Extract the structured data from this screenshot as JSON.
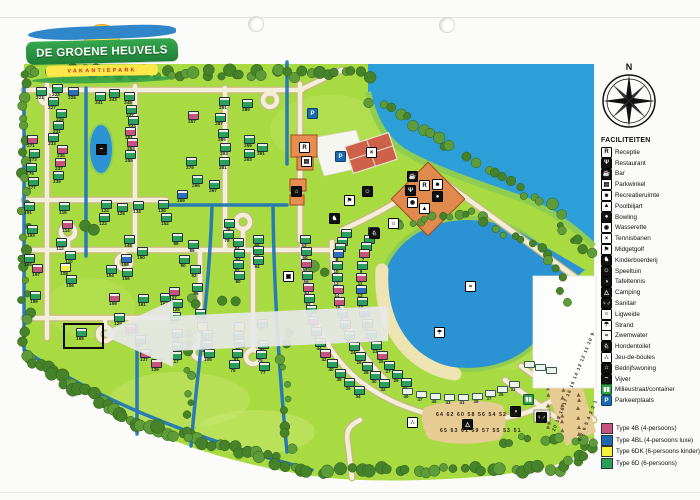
{
  "logo": {
    "line1": "DE GROENE HEUVELS",
    "line2": "VAKANTIEPARK"
  },
  "compass": {
    "north": "N"
  },
  "facilities_legend": {
    "title": "FACILITEITEN",
    "items": [
      {
        "label": "Receptie",
        "icon": "R",
        "variant": "light"
      },
      {
        "label": "Restaurant",
        "icon": "Ψ",
        "variant": "dark"
      },
      {
        "label": "Bar",
        "icon": "☕",
        "variant": "dark"
      },
      {
        "label": "Parkwinkel",
        "icon": "▤",
        "variant": "light"
      },
      {
        "label": "Recreatieruimte",
        "icon": "☻",
        "variant": "light"
      },
      {
        "label": "Poolbiljart",
        "icon": "▲",
        "variant": "light"
      },
      {
        "label": "Bowling",
        "icon": "●",
        "variant": "dark"
      },
      {
        "label": "Wasserette",
        "icon": "◉",
        "variant": "light"
      },
      {
        "label": "Tennisbanen",
        "icon": "×",
        "variant": "light"
      },
      {
        "label": "Midgetgolf",
        "icon": "⚑",
        "variant": "light"
      },
      {
        "label": "Kinderboerderij",
        "icon": "♞",
        "variant": "dark"
      },
      {
        "label": "Speeltuin",
        "icon": "☺",
        "variant": "dark"
      },
      {
        "label": "Tafeltennis",
        "icon": "◑",
        "variant": "dark"
      },
      {
        "label": "Camping",
        "icon": "△",
        "variant": "dark"
      },
      {
        "label": "Sanitair",
        "icon": "♀♂",
        "variant": "dark"
      },
      {
        "label": "Ligweide",
        "icon": "☼",
        "variant": "light"
      },
      {
        "label": "Strand",
        "icon": "☂",
        "variant": "light"
      },
      {
        "label": "Zwemwater",
        "icon": "≈",
        "variant": "light"
      },
      {
        "label": "Hondentoilet",
        "icon": "♘",
        "variant": "dark"
      },
      {
        "label": "Jeu-de-boules",
        "icon": "∴",
        "variant": "light"
      },
      {
        "label": "Bedrijfswoning",
        "icon": "⌂",
        "variant": "dark"
      },
      {
        "label": "Vijver",
        "icon": "~",
        "variant": "dark"
      },
      {
        "label": "Milieustraat/container",
        "icon": "▮▮",
        "variant": "green"
      },
      {
        "label": "Parkeerplaats",
        "icon": "P",
        "variant": "blue"
      }
    ]
  },
  "type_legend": {
    "items": [
      {
        "label": "Type 4B (4-persoons)",
        "color": "#c9537f"
      },
      {
        "label": "Type 4BL (4-persoons luxe)",
        "color": "#1d6ab0"
      },
      {
        "label": "Type 6DK (6-persoons kinder)",
        "color": "#f6f23c"
      },
      {
        "label": "Type 6D (6-persoons)",
        "color": "#2aa05c"
      }
    ]
  },
  "map": {
    "highlighted_plot": "165",
    "camping_field_rows": {
      "row1": "64 62 60 58 56 54 52 50",
      "row2": "65 63 61 59 57 55 53 51"
    },
    "pitch_rows": {
      "row1": "20 19 18 17 16 15 14 13 12 11 10 9",
      "row2": "8 7 6 5 4 3 2 1"
    },
    "type_colors": {
      "g": "#2aa05c",
      "p": "#c9537f",
      "b": "#2e6fbd",
      "y": "#f2ee4e"
    },
    "plots": [
      [
        "221",
        "g",
        40,
        90
      ],
      [
        "223",
        "g",
        56,
        87
      ],
      [
        "225",
        "b",
        72,
        90
      ],
      [
        "227",
        "g",
        52,
        100
      ],
      [
        "229",
        "g",
        60,
        112
      ],
      [
        "231",
        "g",
        57,
        124
      ],
      [
        "233",
        "g",
        52,
        136
      ],
      [
        "235",
        "p",
        61,
        148
      ],
      [
        "237",
        "p",
        59,
        161
      ],
      [
        "239",
        "g",
        57,
        174
      ],
      [
        "241",
        "g",
        99,
        95
      ],
      [
        "243",
        "g",
        113,
        92
      ],
      [
        "245",
        "g",
        128,
        95
      ],
      [
        "247",
        "g",
        130,
        108
      ],
      [
        "249",
        "g",
        132,
        119
      ],
      [
        "251",
        "p",
        129,
        130
      ],
      [
        "253",
        "p",
        131,
        141
      ],
      [
        "255",
        "g",
        129,
        153
      ],
      [
        "271",
        "p",
        31,
        138
      ],
      [
        "273",
        "g",
        33,
        152
      ],
      [
        "275",
        "g",
        30,
        166
      ],
      [
        "277",
        "g",
        32,
        180
      ],
      [
        "291",
        "g",
        223,
        100
      ],
      [
        "289",
        "g",
        246,
        102
      ],
      [
        "287",
        "g",
        219,
        116
      ],
      [
        "285",
        "g",
        222,
        132
      ],
      [
        "283",
        "g",
        224,
        146
      ],
      [
        "281",
        "g",
        223,
        160
      ],
      [
        "279",
        "g",
        190,
        160
      ],
      [
        "257",
        "p",
        192,
        114
      ],
      [
        "259",
        "g",
        248,
        138
      ],
      [
        "261",
        "g",
        261,
        146
      ],
      [
        "263",
        "g",
        248,
        152
      ],
      [
        "265",
        "g",
        196,
        178
      ],
      [
        "267",
        "g",
        213,
        183
      ],
      [
        "269",
        "b",
        181,
        193
      ],
      [
        "116",
        "g",
        63,
        205
      ],
      [
        "114",
        "p",
        66,
        223
      ],
      [
        "112",
        "g",
        60,
        241
      ],
      [
        "110",
        "g",
        69,
        254
      ],
      [
        "108",
        "y",
        64,
        266
      ],
      [
        "106",
        "g",
        70,
        278
      ],
      [
        "191",
        "g",
        28,
        205
      ],
      [
        "193",
        "g",
        31,
        228
      ],
      [
        "195",
        "g",
        28,
        257
      ],
      [
        "197",
        "p",
        36,
        267
      ],
      [
        "199",
        "g",
        34,
        294
      ],
      [
        "124",
        "g",
        105,
        203
      ],
      [
        "122",
        "g",
        103,
        216
      ],
      [
        "126",
        "g",
        121,
        206
      ],
      [
        "134",
        "g",
        137,
        204
      ],
      [
        "136",
        "g",
        162,
        203
      ],
      [
        "148",
        "g",
        128,
        238
      ],
      [
        "150",
        "g",
        141,
        250
      ],
      [
        "152",
        "g",
        165,
        216
      ],
      [
        "158",
        "b",
        125,
        257
      ],
      [
        "154",
        "g",
        110,
        268
      ],
      [
        "156",
        "g",
        126,
        271
      ],
      [
        "159",
        "p",
        113,
        296
      ],
      [
        "161",
        "g",
        142,
        297
      ],
      [
        "163",
        "g",
        164,
        296
      ],
      [
        "129",
        "g",
        118,
        316
      ],
      [
        "131",
        "p",
        129,
        327
      ],
      [
        "133",
        "g",
        139,
        338
      ],
      [
        "137",
        "p",
        144,
        352
      ],
      [
        "139",
        "p",
        155,
        362
      ],
      [
        "165",
        "g",
        80,
        331
      ],
      [
        "86",
        "g",
        192,
        243
      ],
      [
        "88",
        "g",
        176,
        236
      ],
      [
        "90",
        "g",
        183,
        258
      ],
      [
        "92",
        "g",
        194,
        268
      ],
      [
        "94",
        "g",
        238,
        252
      ],
      [
        "84",
        "g",
        237,
        241
      ],
      [
        "76",
        "g",
        228,
        222
      ],
      [
        "78",
        "g",
        227,
        233
      ],
      [
        "68",
        "g",
        257,
        238
      ],
      [
        "66",
        "g",
        257,
        249
      ],
      [
        "64",
        "g",
        257,
        259
      ],
      [
        "82",
        "g",
        237,
        263
      ],
      [
        "80",
        "g",
        238,
        274
      ],
      [
        "127",
        "p",
        173,
        290
      ],
      [
        "125",
        "g",
        176,
        302
      ],
      [
        "123",
        "g",
        174,
        315
      ],
      [
        "95",
        "g",
        196,
        286
      ],
      [
        "97",
        "g",
        199,
        312
      ],
      [
        "99",
        "y",
        201,
        325
      ],
      [
        "101",
        "g",
        206,
        333
      ],
      [
        "103",
        "g",
        206,
        343
      ],
      [
        "65",
        "y",
        238,
        325
      ],
      [
        "63",
        "g",
        237,
        334
      ],
      [
        "71",
        "g",
        261,
        322
      ],
      [
        "73",
        "g",
        262,
        343
      ],
      [
        "75",
        "g",
        260,
        353
      ],
      [
        "77",
        "g",
        263,
        365
      ],
      [
        "79",
        "g",
        233,
        363
      ],
      [
        "81",
        "g",
        238,
        342
      ],
      [
        "83",
        "g",
        236,
        352
      ],
      [
        "121",
        "g",
        176,
        332
      ],
      [
        "119",
        "g",
        176,
        345
      ],
      [
        "117",
        "g",
        175,
        354
      ],
      [
        "105",
        "g",
        208,
        352
      ],
      [
        "62",
        "g",
        304,
        238
      ],
      [
        "60",
        "g",
        305,
        250
      ],
      [
        "58",
        "p",
        305,
        262
      ],
      [
        "56",
        "g",
        306,
        274
      ],
      [
        "54",
        "p",
        307,
        286
      ],
      [
        "52",
        "g",
        308,
        297
      ],
      [
        "50",
        "g",
        310,
        308
      ],
      [
        "48",
        "p",
        312,
        319
      ],
      [
        "46",
        "g",
        315,
        330
      ],
      [
        "44",
        "g",
        319,
        341
      ],
      [
        "42",
        "p",
        324,
        352
      ],
      [
        "40",
        "g",
        331,
        362
      ],
      [
        "38",
        "g",
        339,
        372
      ],
      [
        "36",
        "g",
        348,
        381
      ],
      [
        "34",
        "g",
        358,
        389
      ],
      [
        "2",
        "g",
        345,
        232
      ],
      [
        "4",
        "g",
        341,
        240
      ],
      [
        "6",
        "g",
        339,
        246
      ],
      [
        "8",
        "b",
        337,
        252
      ],
      [
        "10",
        "g",
        336,
        264
      ],
      [
        "12",
        "g",
        336,
        276
      ],
      [
        "14",
        "p",
        337,
        288
      ],
      [
        "16",
        "p",
        338,
        300
      ],
      [
        "18",
        "g",
        341,
        312
      ],
      [
        "20",
        "g",
        344,
        323
      ],
      [
        "22",
        "g",
        348,
        334
      ],
      [
        "24",
        "g",
        353,
        345
      ],
      [
        "26",
        "g",
        359,
        355
      ],
      [
        "28",
        "g",
        366,
        365
      ],
      [
        "30",
        "g",
        374,
        374
      ],
      [
        "32",
        "g",
        383,
        382
      ],
      [
        "1",
        "g",
        372,
        230
      ],
      [
        "3",
        "g",
        368,
        238
      ],
      [
        "5",
        "g",
        365,
        245
      ],
      [
        "7",
        "p",
        363,
        252
      ],
      [
        "9",
        "g",
        361,
        264
      ],
      [
        "11",
        "p",
        360,
        276
      ],
      [
        "13",
        "b",
        360,
        288
      ],
      [
        "15",
        "g",
        361,
        300
      ],
      [
        "17",
        "b",
        363,
        311
      ],
      [
        "19",
        "g",
        366,
        322
      ],
      [
        "21",
        "g",
        370,
        333
      ],
      [
        "23",
        "g",
        375,
        344
      ],
      [
        "25",
        "p",
        381,
        354
      ],
      [
        "27",
        "g",
        388,
        364
      ],
      [
        "29",
        "g",
        396,
        373
      ],
      [
        "31",
        "g",
        405,
        381
      ]
    ],
    "caravans": [
      [
        "49",
        406,
        390
      ],
      [
        "47",
        420,
        393
      ],
      [
        "45",
        434,
        395
      ],
      [
        "43",
        448,
        396
      ],
      [
        "41",
        462,
        396
      ],
      [
        "39",
        476,
        395
      ],
      [
        "37",
        489,
        392
      ],
      [
        "35",
        501,
        388
      ],
      [
        "33",
        513,
        383
      ],
      [
        "",
        528,
        363
      ],
      [
        "",
        539,
        366
      ],
      [
        "",
        550,
        369
      ]
    ],
    "markers": [
      [
        "receptie",
        "R",
        "light",
        304,
        147
      ],
      [
        "parkwinkel",
        "▤",
        "light",
        306,
        161
      ],
      [
        "parkeerplaats-1",
        "P",
        "blue",
        312,
        113
      ],
      [
        "parkeerplaats-2",
        "P",
        "blue",
        340,
        156
      ],
      [
        "tennisbanen",
        "×",
        "light",
        371,
        152
      ],
      [
        "speeltuin",
        "☺",
        "dark",
        367,
        191
      ],
      [
        "midgetgolf",
        "⚑",
        "light",
        349,
        200
      ],
      [
        "bedrijfswoning",
        "⌂",
        "dark",
        296,
        191
      ],
      [
        "kinderboerderij",
        "♞",
        "dark",
        334,
        218
      ],
      [
        "hondentoilet",
        "♘",
        "dark",
        374,
        233
      ],
      [
        "ligweide",
        "☼",
        "light",
        393,
        223
      ],
      [
        "bar",
        "☕",
        "dark",
        412,
        176
      ],
      [
        "restaurant",
        "Ψ",
        "dark",
        410,
        190
      ],
      [
        "receptie-2",
        "R",
        "light",
        424,
        185
      ],
      [
        "recreatieruimte",
        "☻",
        "light",
        437,
        184
      ],
      [
        "wasserette",
        "◉",
        "light",
        412,
        202
      ],
      [
        "bowling",
        "●",
        "dark",
        437,
        196
      ],
      [
        "poolbiljart",
        "▲",
        "light",
        424,
        208
      ],
      [
        "zwemwater",
        "≈",
        "light",
        470,
        286
      ],
      [
        "strand",
        "☂",
        "light",
        439,
        332
      ],
      [
        "vijver",
        "~",
        "dark",
        101,
        149
      ],
      [
        "tafeltennis",
        "◑",
        "dark",
        515,
        411
      ],
      [
        "jeu-de-boules",
        "∴",
        "light",
        412,
        422
      ],
      [
        "sanitair",
        "♀♂",
        "dark",
        541,
        417
      ],
      [
        "milieustraat",
        "▮▮",
        "green",
        528,
        399
      ],
      [
        "camping",
        "△",
        "dark",
        467,
        424
      ],
      [
        "utility",
        "▣",
        "light",
        288,
        276
      ]
    ]
  }
}
